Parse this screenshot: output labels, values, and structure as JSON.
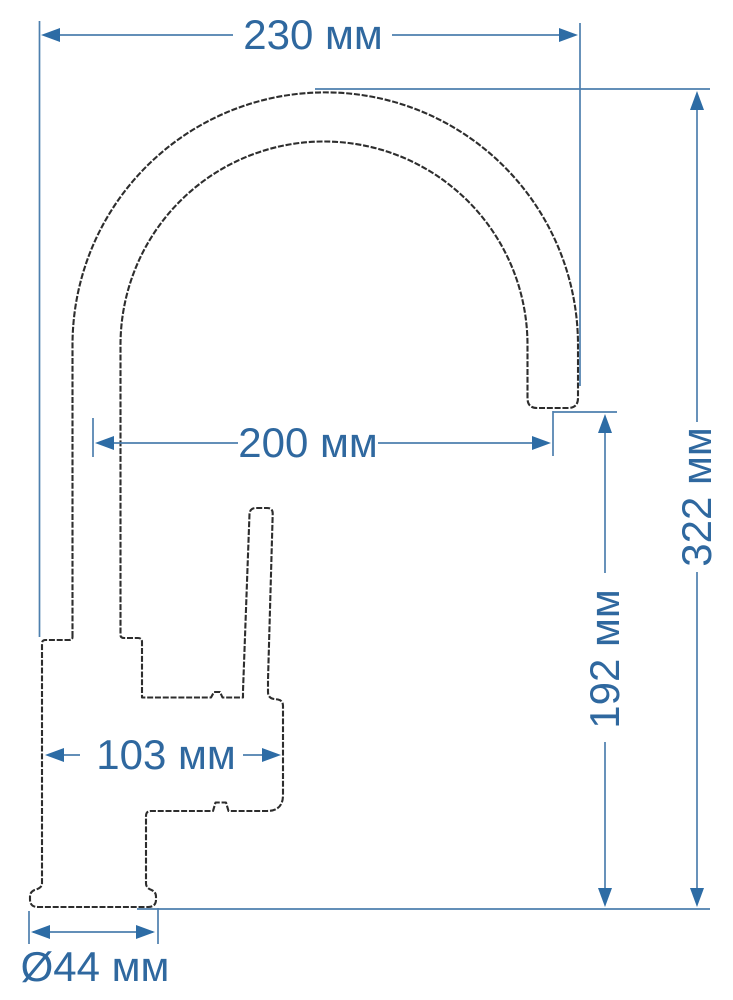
{
  "drawing": {
    "subject": "kitchen-faucet-technical-dimension-drawing",
    "unit": "мм",
    "colors": {
      "dimension_text": "#2f689f",
      "dimension_line": "#4d7fae",
      "arrowhead": "#2d6ca5",
      "outline": "#2d2d2d",
      "background": "#ffffff"
    },
    "dimensions": {
      "width_overall": {
        "label": "230 мм",
        "value": 230
      },
      "spout_reach": {
        "label": "200 мм",
        "value": 200
      },
      "height_overall": {
        "label": "322 мм",
        "value": 322
      },
      "height_to_spout": {
        "label": "192 мм",
        "value": 192
      },
      "body_length": {
        "label": "103 мм",
        "value": 103
      },
      "base_diameter": {
        "label": "Ø44 мм",
        "value": 44
      }
    }
  }
}
